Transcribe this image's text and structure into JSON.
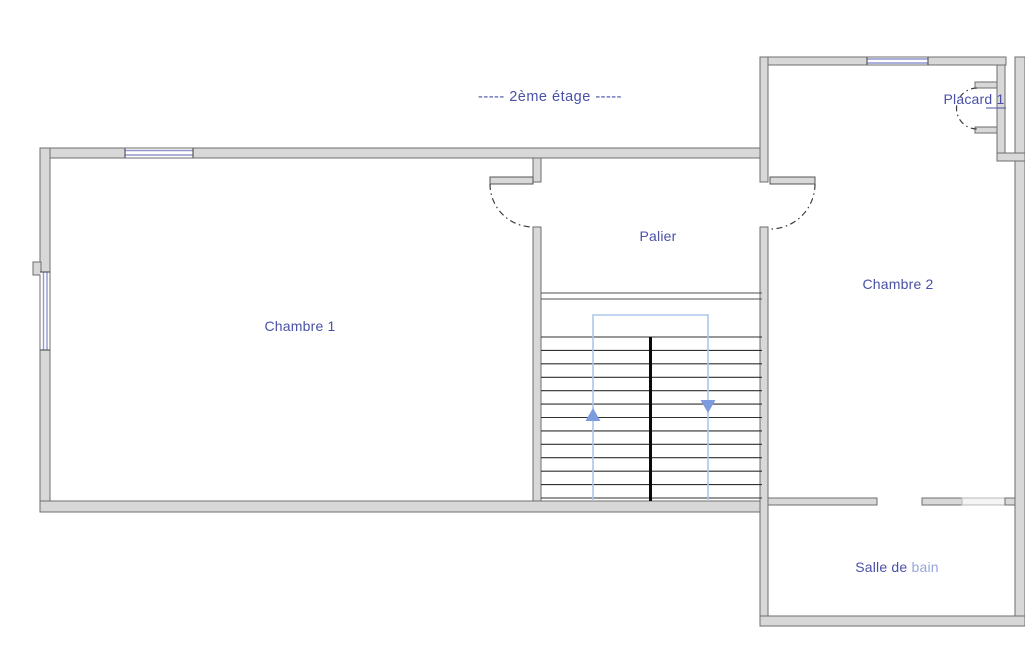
{
  "title": "-----  2ème étage  -----",
  "rooms": {
    "chambre1": {
      "label": "Chambre 1"
    },
    "palier": {
      "label": "Palier"
    },
    "chambre2": {
      "label": "Chambre 2"
    },
    "placard": {
      "label": "Placard 1"
    },
    "salle_de_bain": {
      "label_main": "Salle de",
      "label_faded": "bain"
    }
  },
  "icons": {
    "stairs_up": "triangle-up-arrow",
    "stairs_down": "triangle-down-arrow"
  },
  "colors": {
    "wall_fill": "#d8d8d8",
    "wall_stroke": "#6e6e6e",
    "label_text": "#4a50a8",
    "label_faded": "#97a6d8",
    "window_blue": "#9296cc",
    "stair_guide_blue": "#adc6ec",
    "arrow_blue": "#7d9ce0",
    "tread_dark": "#2f2f2f"
  }
}
